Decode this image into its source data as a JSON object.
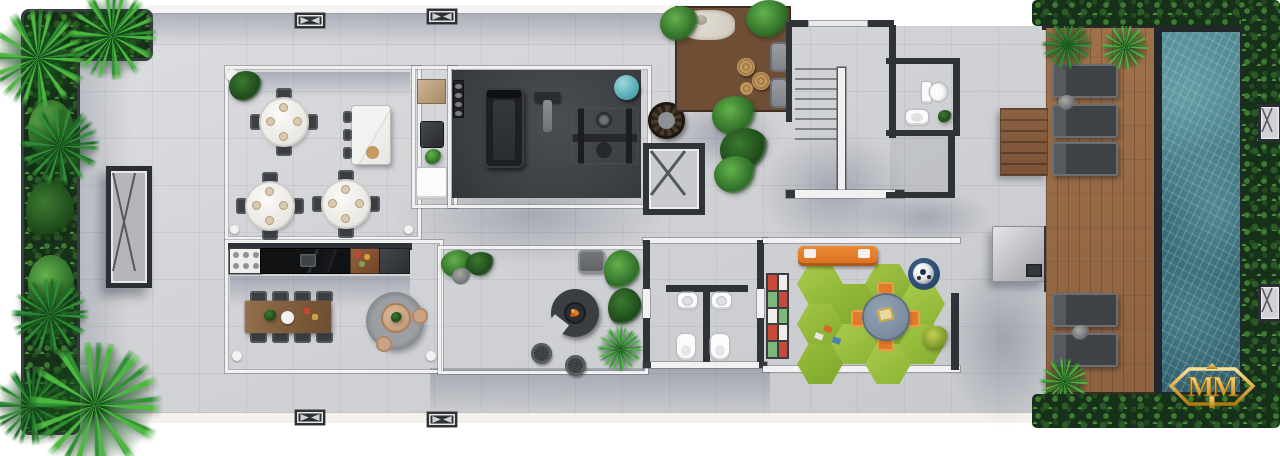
{
  "logo": {
    "text": "MM",
    "color_gold": "#e4b44a"
  },
  "palette": {
    "background": "#ffffff",
    "terrace_tile": "#d2d4d7",
    "wall_dark": "#2f3237",
    "wall_light": "#f1f1f2",
    "gym_floor": "#43464b",
    "pool_water": "#35707e",
    "pool_rim": "#23272b",
    "deck_wood": "#9c6f4c",
    "zen_deck_wood": "#6b4a33",
    "grass_mat_green": "#9ec43e",
    "kids_accent_orange": "#e07b28",
    "toy_shelf_red": "#c74a3a",
    "toy_shelf_green": "#7cb87a",
    "foliage_dark": "#1f3a1c",
    "foliage_bright": "#49b33c",
    "exercise_ball_teal": "#60b6c0",
    "furniture_beige": "#c9a384",
    "table_wood": "#8a6344",
    "fire_ember_orange": "#e07b2a"
  },
  "rooms": [
    "multipurpose-dining-room",
    "gourmet-kitchen",
    "pantry",
    "gym",
    "zen-garden",
    "staircase",
    "upper-bathroom",
    "storage-room",
    "firepit-lounge",
    "restrooms",
    "kids-playroom",
    "outdoor-kitchen",
    "pool-deck",
    "pool",
    "perimeter-gardens"
  ],
  "furniture_icons": [
    "round-dining-table-icon",
    "dining-chair-icon",
    "kitchen-island-icon",
    "bar-stool-icon",
    "stove-icon",
    "marble-counter-icon",
    "long-dining-table-icon",
    "round-rug-icon",
    "treadmill-icon",
    "weight-bench-icon",
    "multi-gym-icon",
    "exercise-ball-icon",
    "dumbbell-rack-icon",
    "egg-chair-icon",
    "elevator-icon",
    "stairs-icon",
    "toilet-icon",
    "sink-icon",
    "fire-pit-sofa-icon",
    "wire-stool-icon",
    "armchair-icon",
    "toy-shelf-icon",
    "kids-sofa-icon",
    "kids-table-icon",
    "soccer-ball-icon",
    "grass-hex-mat-icon",
    "sun-lounger-icon",
    "outdoor-shower-icon",
    "deck-steps-icon",
    "zen-stool-icon",
    "pebble-bed-icon",
    "palm-tree-icon",
    "hedge-icon",
    "planter-icon",
    "skylight-icon",
    "column-marker-icon"
  ]
}
